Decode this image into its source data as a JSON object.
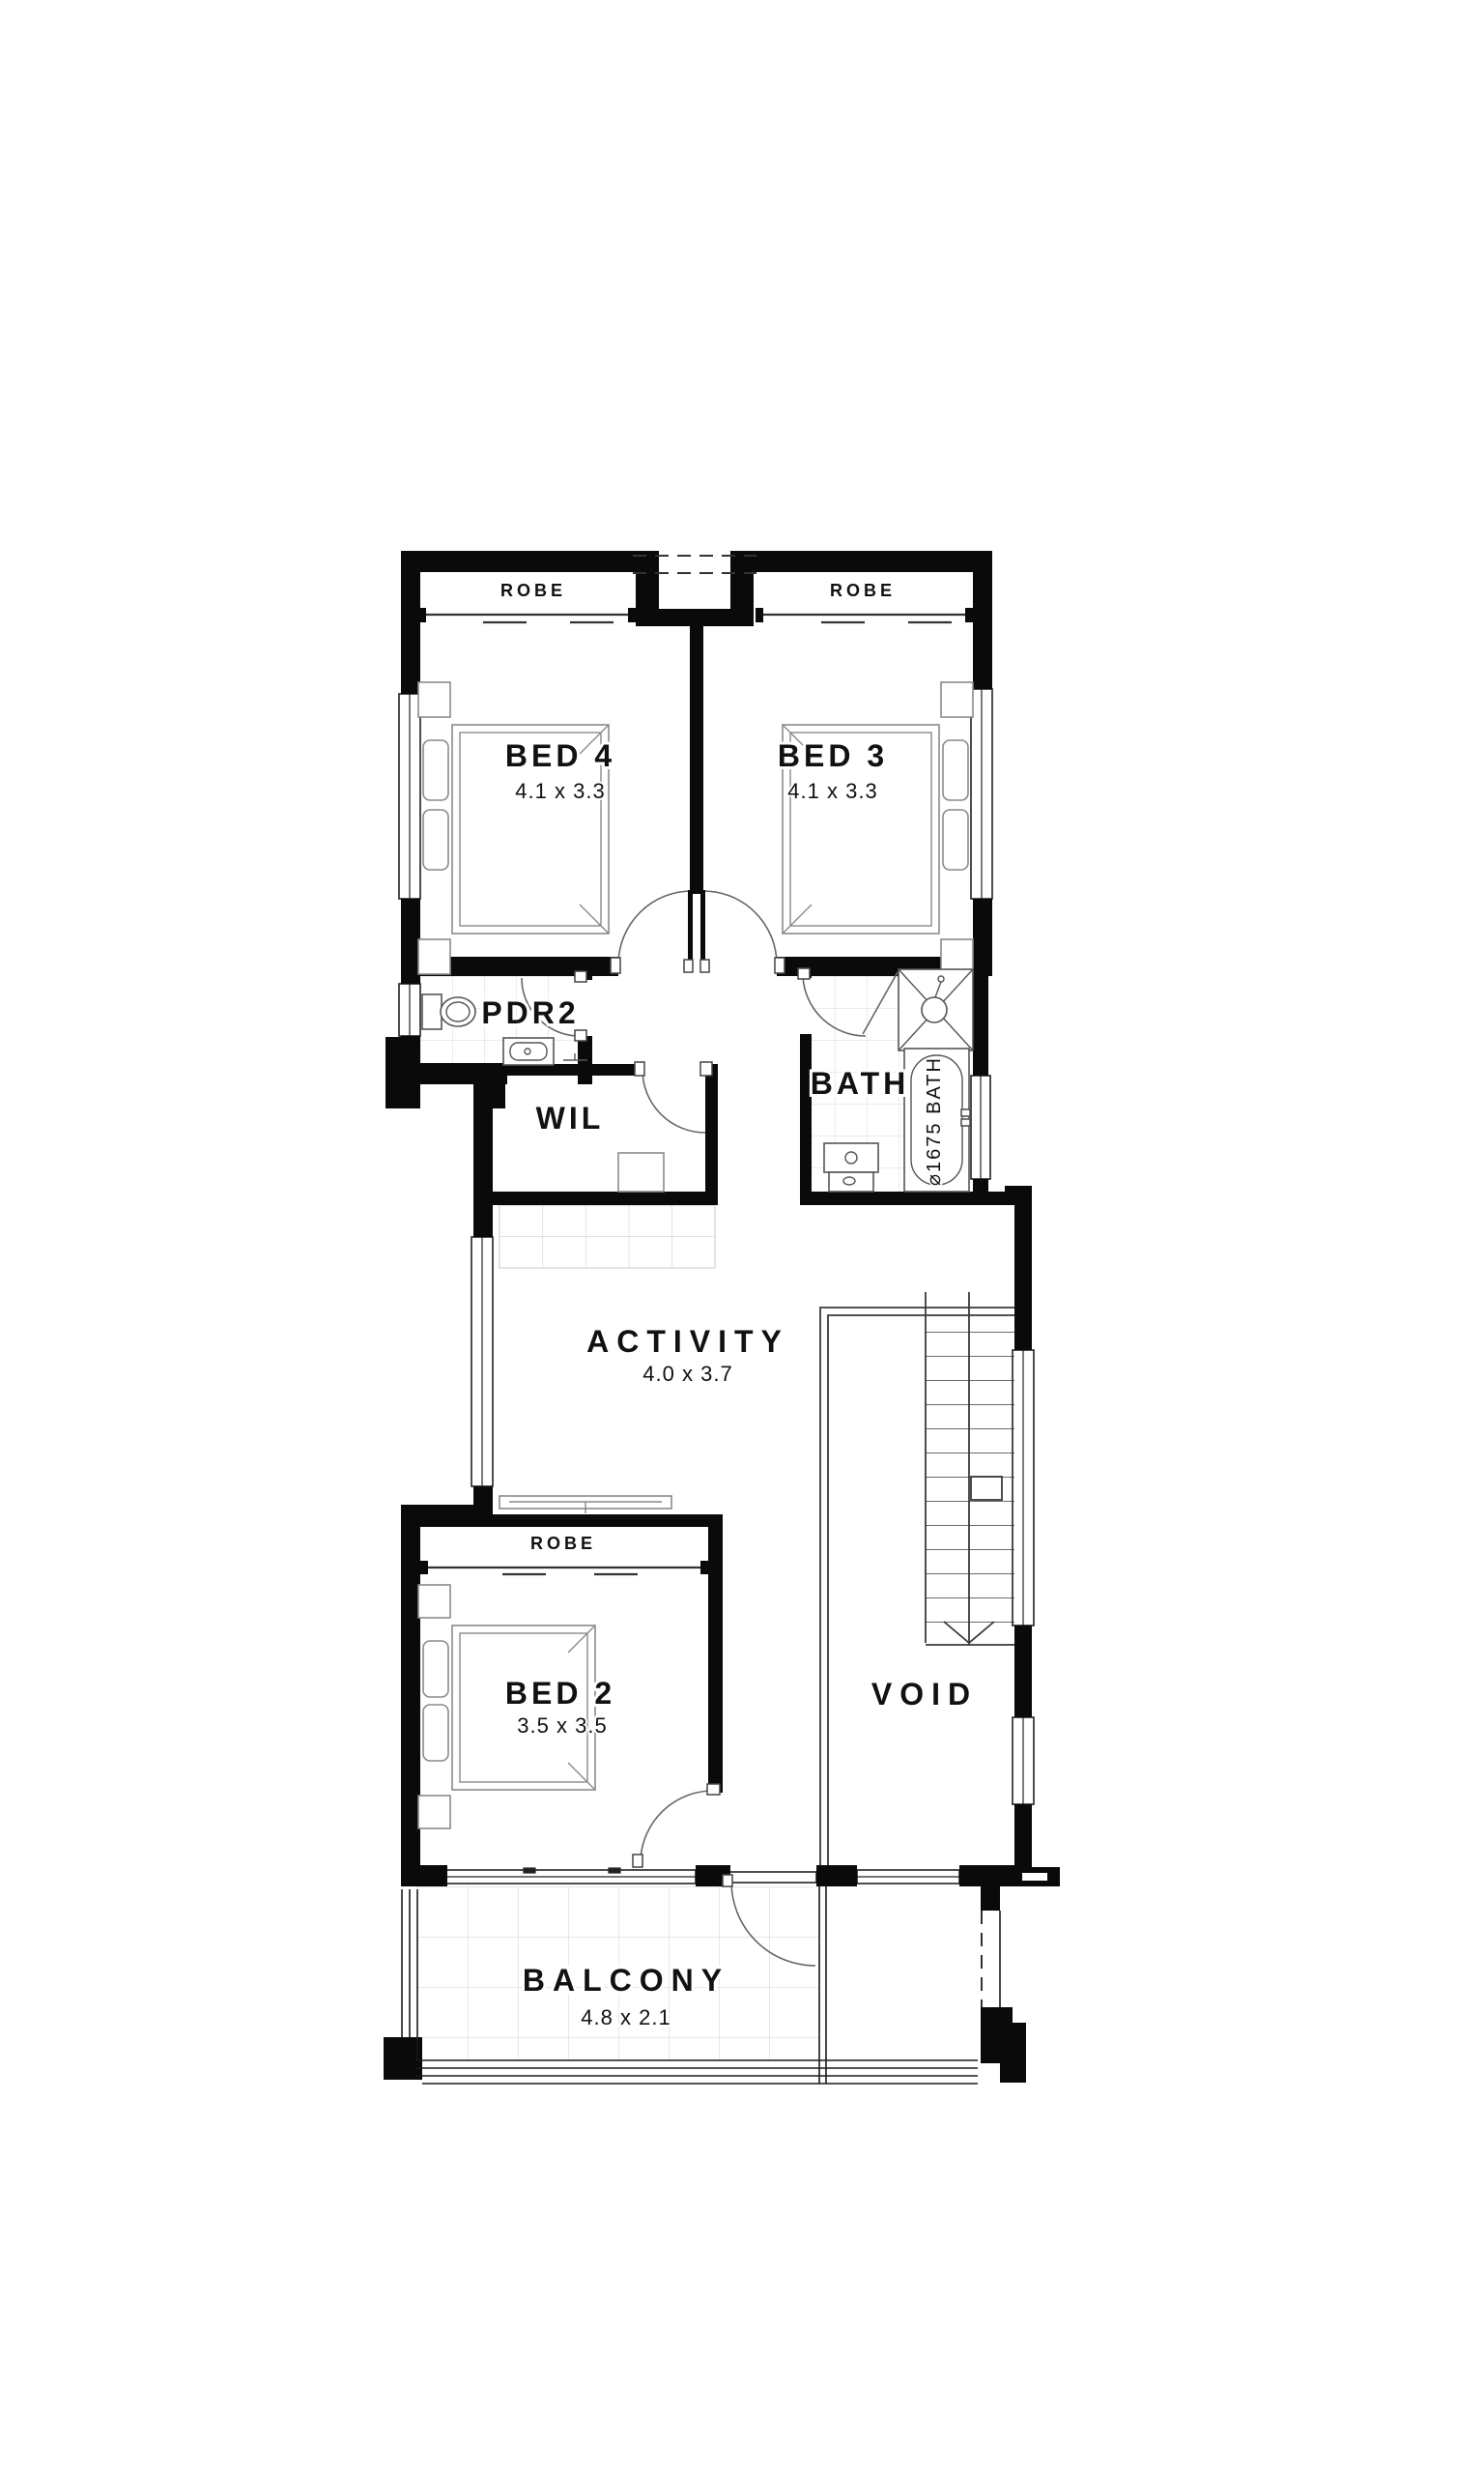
{
  "plan": {
    "bed4": {
      "label": "BED 4",
      "dims": "4.1 x 3.3"
    },
    "bed3": {
      "label": "BED 3",
      "dims": "4.1 x 3.3"
    },
    "bed2": {
      "label": "BED 2",
      "dims": "3.5 x 3.5"
    },
    "activity": {
      "label": "ACTIVITY",
      "dims": "4.0 x 3.7"
    },
    "balcony": {
      "label": "BALCONY",
      "dims": "4.8 x 2.1"
    },
    "bath": {
      "label": "BATH"
    },
    "pdr2": {
      "label": "PDR2"
    },
    "wil": {
      "label": "WIL"
    },
    "void": {
      "label": "VOID"
    },
    "robe_bed4": {
      "label": "ROBE"
    },
    "robe_bed3": {
      "label": "ROBE"
    },
    "robe_bed2": {
      "label": "ROBE"
    },
    "tub": {
      "label": "⌀1675 BATH"
    }
  },
  "colors": {
    "wall": "#0a0a0a",
    "door_swing": "#666666",
    "furniture": "#8a8a8a",
    "fixture": "#555555",
    "tile": "#d8d8d8",
    "background": "#ffffff",
    "text": "#111111"
  }
}
